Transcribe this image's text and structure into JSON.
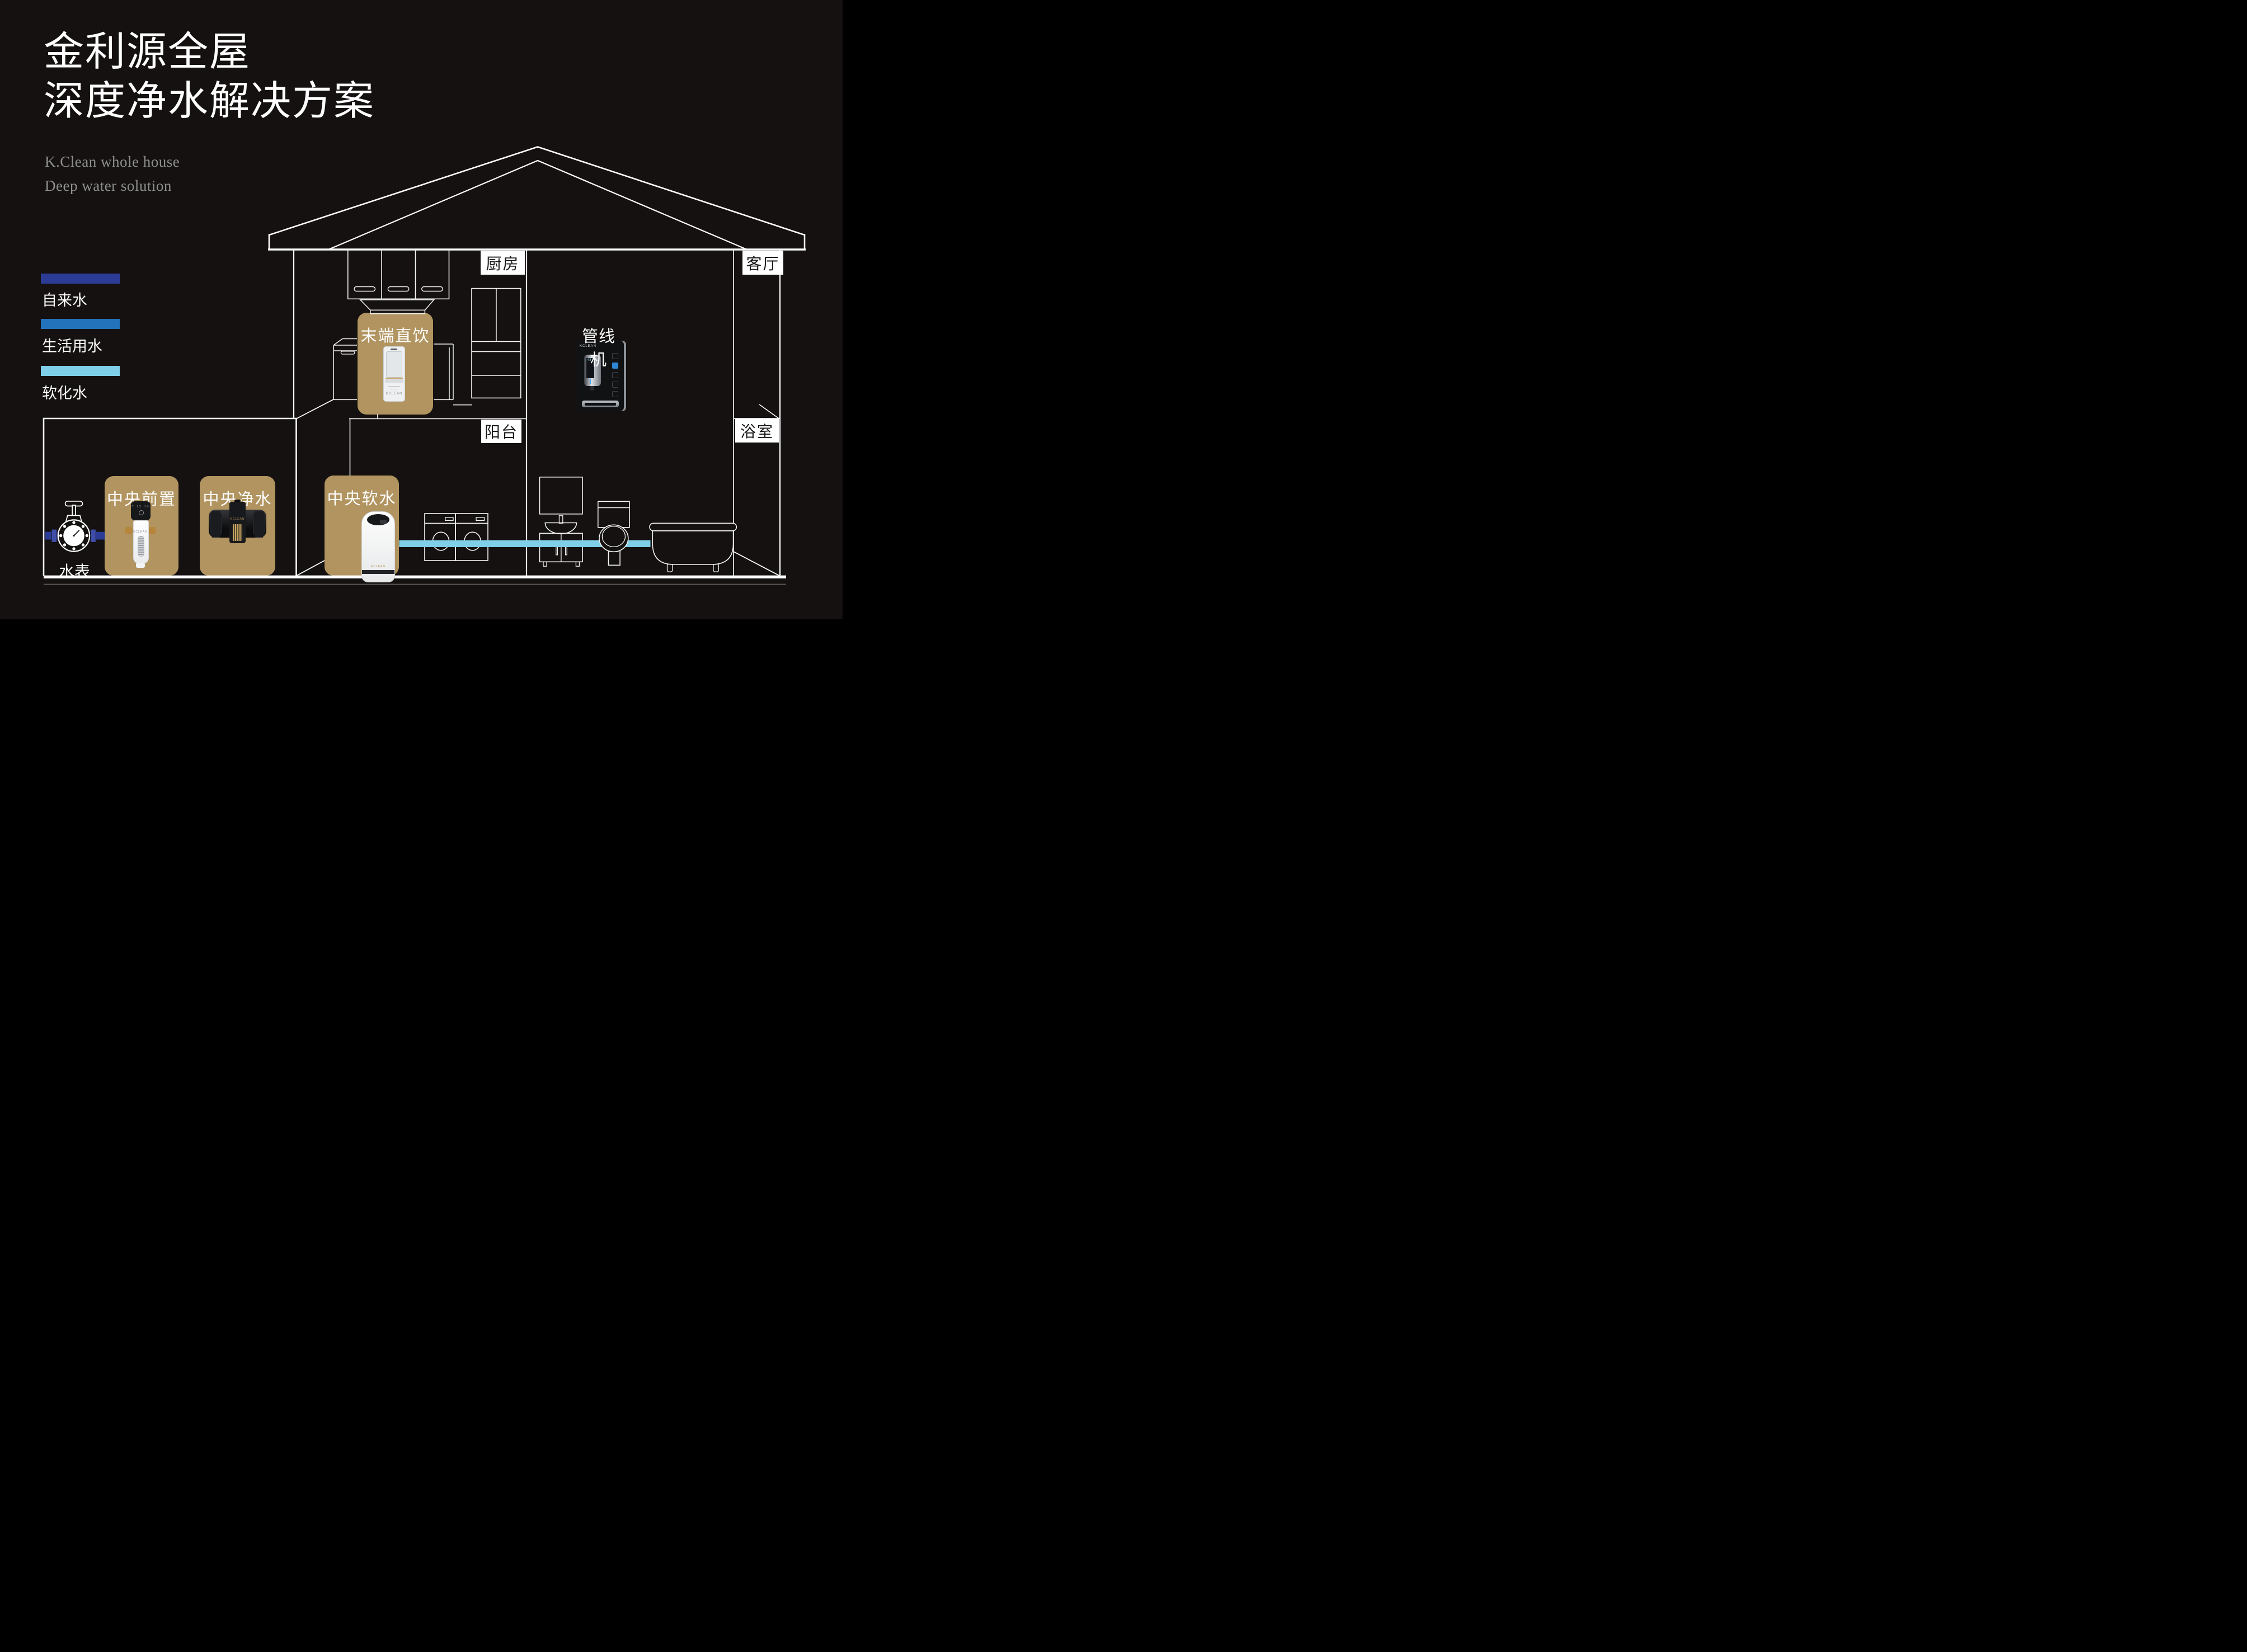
{
  "header": {
    "title_line1": "金利源全屋",
    "title_line2": "深度净水解决方案",
    "subtitle_line1": "K.Clean whole house",
    "subtitle_line2": "Deep water solution"
  },
  "legend": {
    "items": [
      {
        "label": "自来水",
        "color": "#2c3b96"
      },
      {
        "label": "生活用水",
        "color": "#2273bc"
      },
      {
        "label": "软化水",
        "color": "#7ecfe7"
      }
    ]
  },
  "rooms": {
    "kitchen": "厨房",
    "living_room": "客厅",
    "balcony": "阳台",
    "bathroom": "浴室"
  },
  "products": {
    "terminal_direct_drink": "末端直饮",
    "central_prefilter": "中央前置",
    "central_purifier": "中央净水",
    "central_softener": "中央软水",
    "pipeline_machine": "管线机"
  },
  "labels": {
    "water_meter": "水表"
  },
  "brand": "KCLEAN",
  "colors": {
    "background": "#141110",
    "card": "#b19460",
    "tap_water": "#2c3b96",
    "domestic_water": "#2273bc",
    "softened_water": "#7ecfe7",
    "line": "#ffffff"
  }
}
